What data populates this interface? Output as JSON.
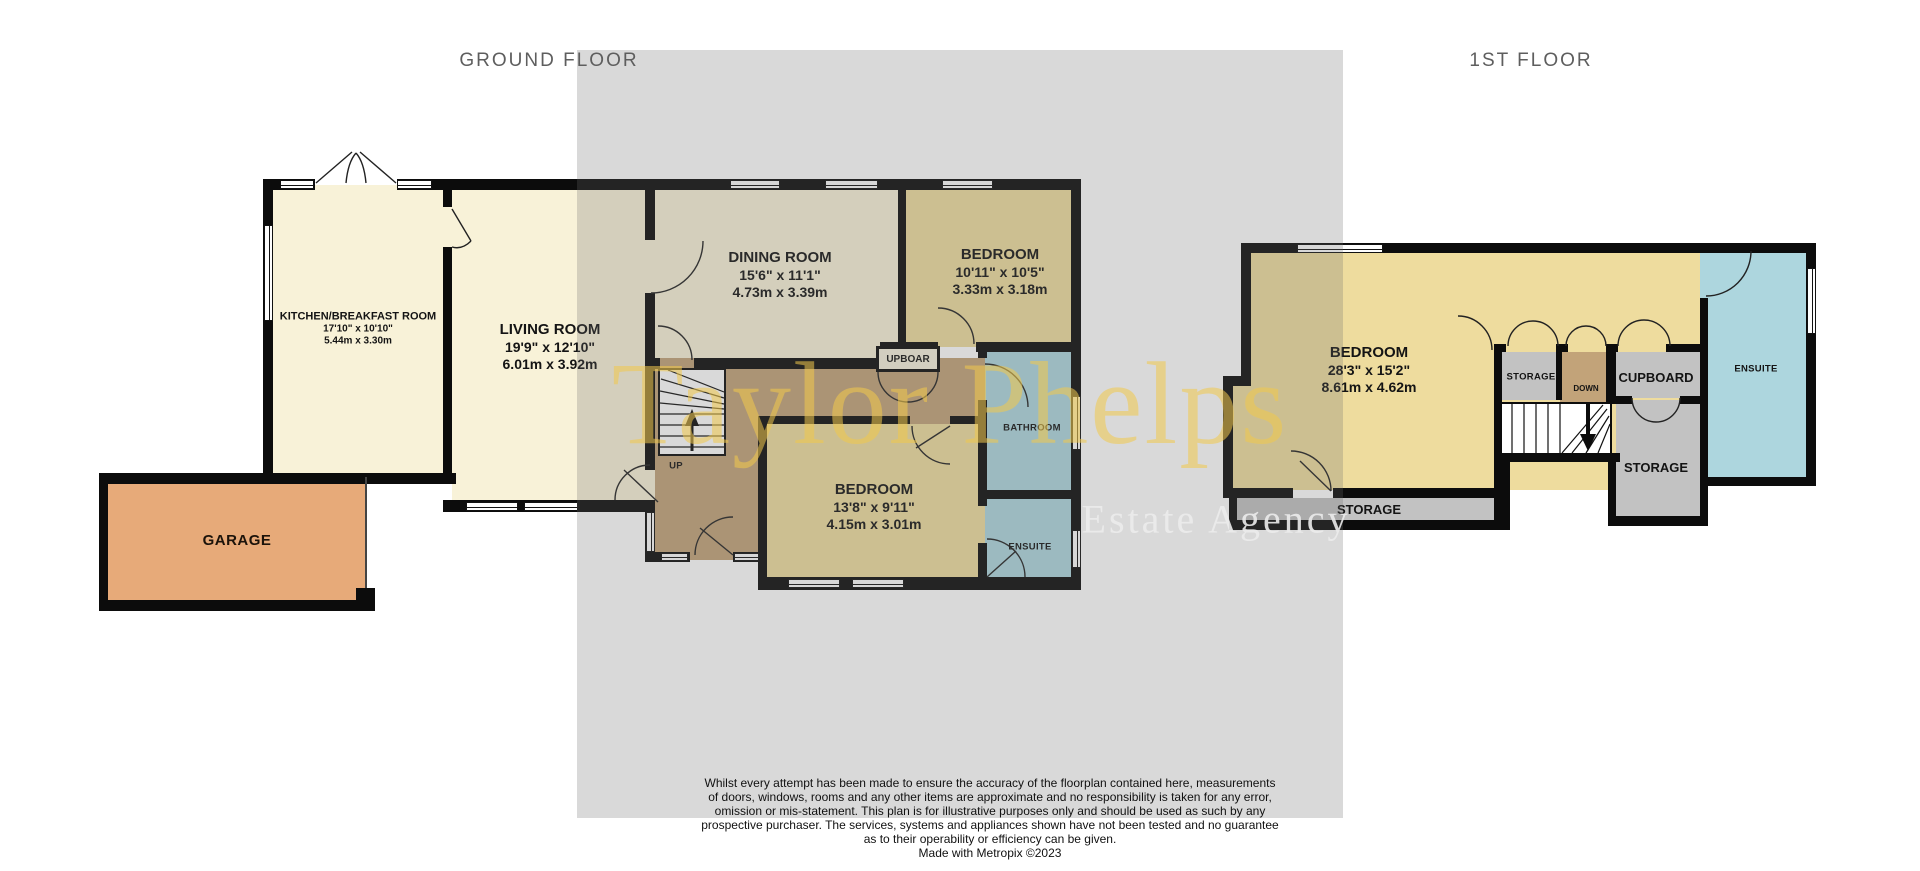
{
  "titles": {
    "ground": "GROUND FLOOR",
    "first": "1ST FLOOR"
  },
  "ground_floor": {
    "kitchen": {
      "name": "KITCHEN/BREAKFAST ROOM",
      "imperial": "17'10\"  x 10'10\"",
      "metric": "5.44m  x 3.30m"
    },
    "living": {
      "name": "LIVING ROOM",
      "imperial": "19'9\"  x 12'10\"",
      "metric": "6.01m  x 3.92m"
    },
    "dining": {
      "name": "DINING ROOM",
      "imperial": "15'6\"  x 11'1\"",
      "metric": "4.73m  x 3.39m"
    },
    "bedroom_right": {
      "name": "BEDROOM",
      "imperial": "10'11\"  x 10'5\"",
      "metric": "3.33m  x 3.18m"
    },
    "bedroom_bottom": {
      "name": "BEDROOM",
      "imperial": "13'8\"  x 9'11\"",
      "metric": "4.15m  x 3.01m"
    },
    "bathroom": {
      "name": "BATHROOM"
    },
    "ensuite": {
      "name": "ENSUITE"
    },
    "cupboard": {
      "name": "UPBOAR"
    },
    "garage": {
      "name": "GARAGE"
    },
    "stairs": {
      "name": "UP"
    }
  },
  "first_floor": {
    "bedroom": {
      "name": "BEDROOM",
      "imperial": "28'3\"  x 15'2\"",
      "metric": "8.61m  x 4.62m"
    },
    "ensuite": {
      "name": "ENSUITE"
    },
    "storage_top": {
      "name": "STORAGE"
    },
    "stairs": {
      "name": "DOWN"
    },
    "cupboard": {
      "name": "CUPBOARD"
    },
    "storage_right": {
      "name": "STORAGE"
    },
    "storage_bottom": {
      "name": "STORAGE"
    }
  },
  "watermark": {
    "primary": "Taylor Phelps",
    "secondary": "Estate Agency",
    "color": "#f2c94c"
  },
  "disclaimer": {
    "lines": [
      "Whilst every attempt has been made to ensure the accuracy of the floorplan contained here, measurements",
      "of doors, windows, rooms and any other items are approximate and no responsibility is taken for any error,",
      "omission or mis-statement. This plan is for illustrative purposes only and should be used as such by any",
      "prospective purchaser. The services, systems and appliances shown have not been tested and no guarantee",
      "as to their operability or efficiency can be given."
    ],
    "credit": "Made with Metropix ©2023"
  },
  "palette": {
    "cream": "#f8f2d8",
    "khaki": "#eedc9e",
    "blue": "#add6de",
    "hall_brown": "#c2a379",
    "garage_orange": "#e7aa79",
    "storage_grey": "#c2c2c2",
    "wall": "#0c0c0c",
    "backdrop_grey": "#d9d9d9",
    "watermark_gold": "#f2c94c"
  }
}
